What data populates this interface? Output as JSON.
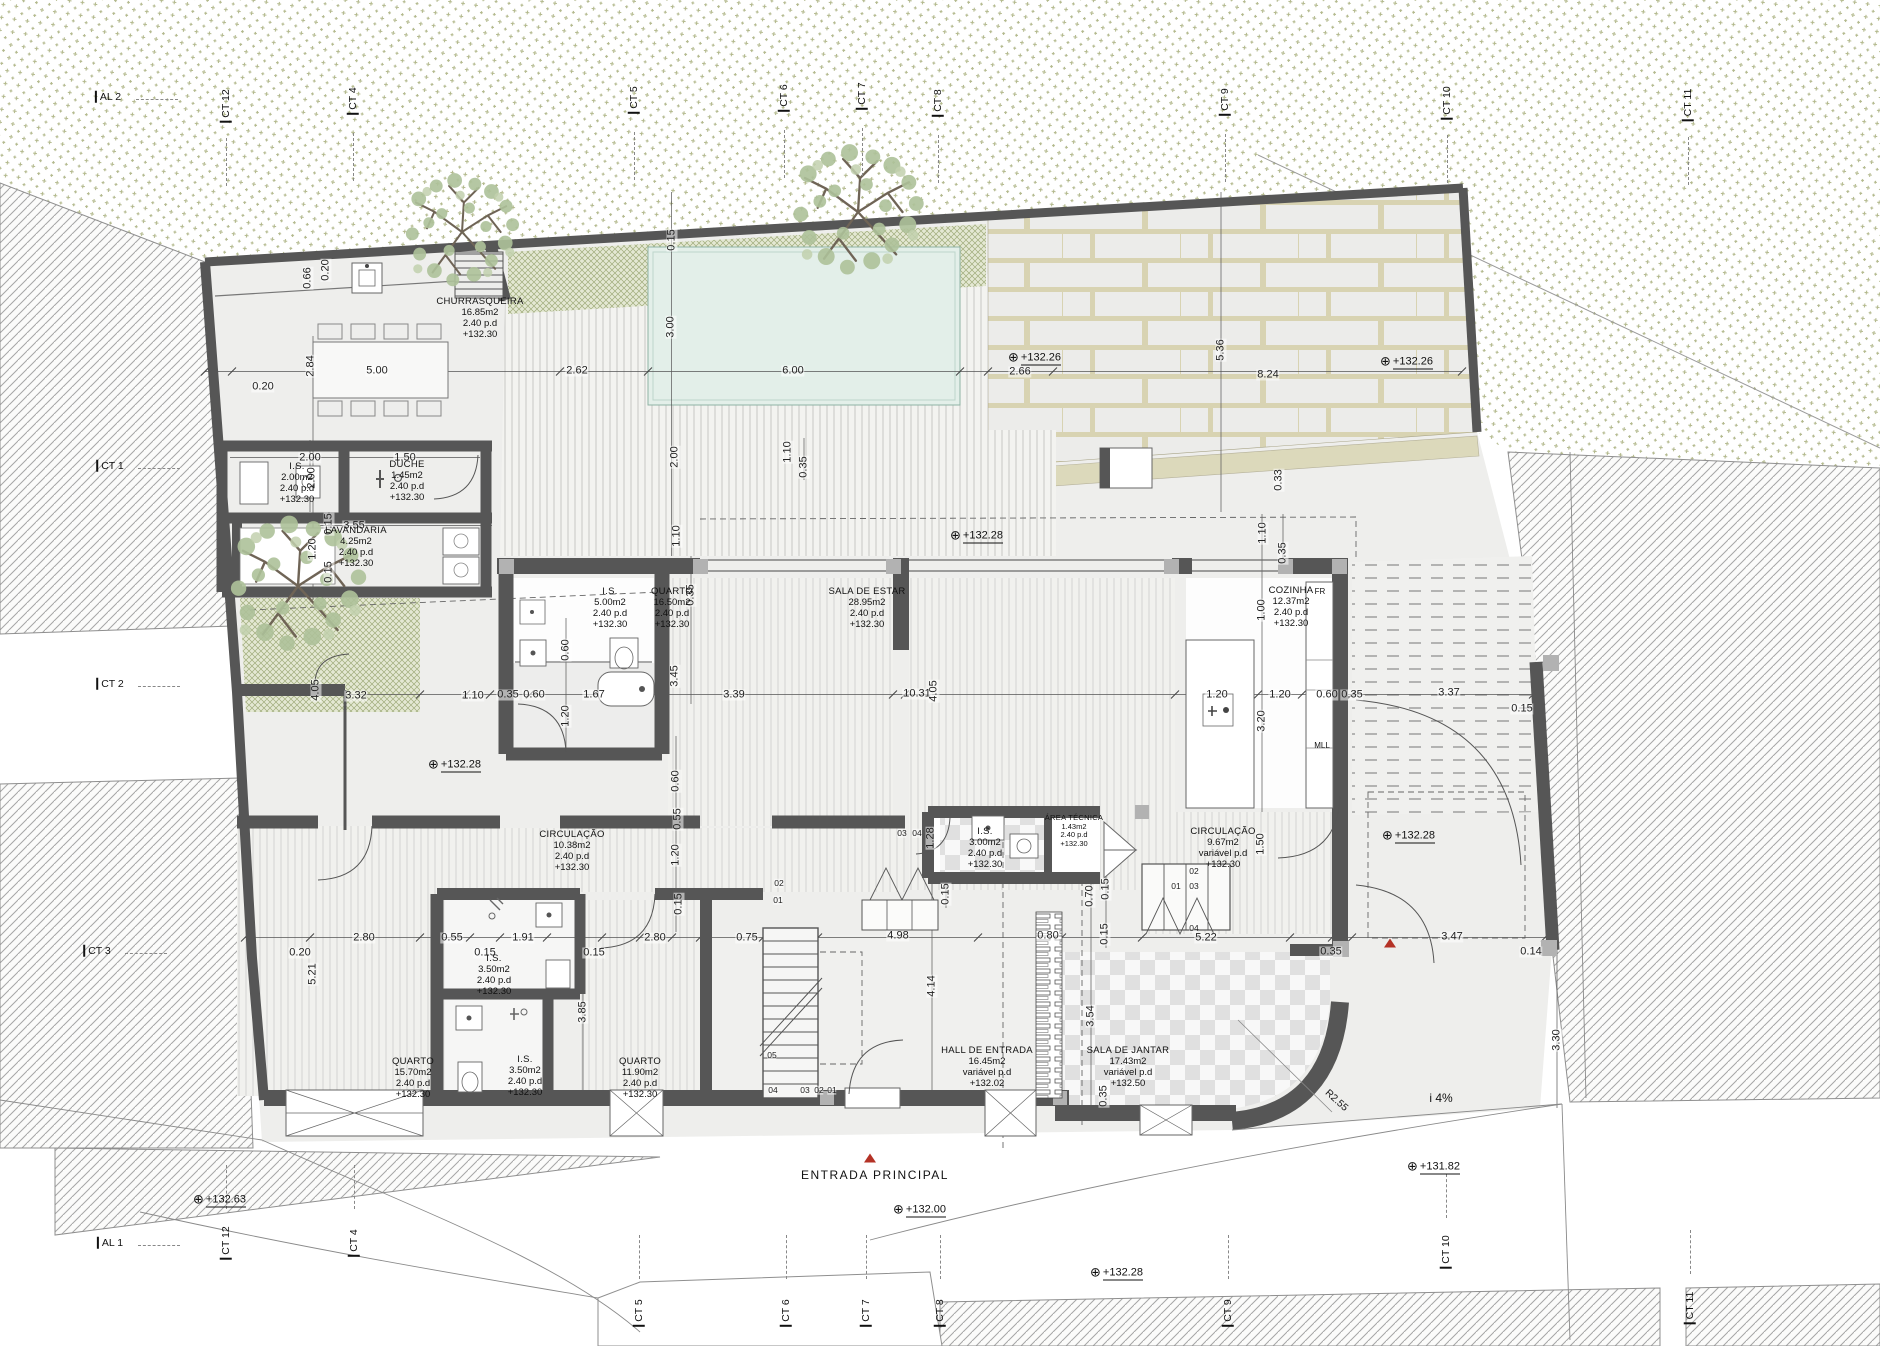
{
  "drawing": {
    "type_label": "floor-plan"
  },
  "colors": {
    "wall": "#565656",
    "accent_red": "#b43226",
    "pool": "#e3efe9",
    "veget": "#98a266",
    "paper": "#ffffff"
  },
  "grid": {
    "top": [
      {
        "t": "AL 2",
        "x": 108,
        "y": 97,
        "o": "h"
      },
      {
        "t": "CT 12",
        "x": 226,
        "y": 106,
        "o": "v"
      },
      {
        "t": "CT 4",
        "x": 353,
        "y": 101,
        "o": "v"
      },
      {
        "t": "CT 5",
        "x": 634,
        "y": 100,
        "o": "v"
      },
      {
        "t": "CT 6",
        "x": 784,
        "y": 98,
        "o": "v"
      },
      {
        "t": "CT 7",
        "x": 862,
        "y": 96,
        "o": "v"
      },
      {
        "t": "CT 8",
        "x": 938,
        "y": 103,
        "o": "v"
      },
      {
        "t": "CT 9",
        "x": 1225,
        "y": 102,
        "o": "v"
      },
      {
        "t": "CT 10",
        "x": 1447,
        "y": 103,
        "o": "v"
      },
      {
        "t": "CT 11",
        "x": 1688,
        "y": 105,
        "o": "v"
      }
    ],
    "left": [
      {
        "t": "CT 1",
        "x": 110,
        "y": 466,
        "o": "h"
      },
      {
        "t": "CT 2",
        "x": 110,
        "y": 684,
        "o": "h"
      },
      {
        "t": "CT 3",
        "x": 97,
        "y": 951,
        "o": "h"
      }
    ],
    "bottom": [
      {
        "t": "AL 1",
        "x": 110,
        "y": 1243,
        "o": "h"
      },
      {
        "t": "CT 12",
        "x": 226,
        "y": 1243,
        "o": "v"
      },
      {
        "t": "CT 4",
        "x": 354,
        "y": 1243,
        "o": "v"
      },
      {
        "t": "CT 5",
        "x": 639,
        "y": 1313,
        "o": "v"
      },
      {
        "t": "CT 6",
        "x": 786,
        "y": 1313,
        "o": "v"
      },
      {
        "t": "CT 7",
        "x": 866,
        "y": 1313,
        "o": "v"
      },
      {
        "t": "CT 8",
        "x": 940,
        "y": 1313,
        "o": "v"
      },
      {
        "t": "CT 9",
        "x": 1228,
        "y": 1313,
        "o": "v"
      },
      {
        "t": "CT 10",
        "x": 1446,
        "y": 1252,
        "o": "v"
      },
      {
        "t": "CT 11",
        "x": 1690,
        "y": 1308,
        "o": "v"
      }
    ]
  },
  "rooms": [
    {
      "name": "CHURRASQUEIRA",
      "area": "16.85m2",
      "height": "2.40  p.d",
      "level": "+132.30",
      "x": 480,
      "y": 319
    },
    {
      "name": "I.S.",
      "area": "2.00m2",
      "height": "2.40  p.d",
      "level": "+132.30",
      "x": 297,
      "y": 484
    },
    {
      "name": "DUCHE",
      "area": "1.45m2",
      "height": "2.40  p.d",
      "level": "+132.30",
      "x": 407,
      "y": 482
    },
    {
      "name": "LAVANDARIA",
      "area": "4.25m2",
      "height": "2.40  p.d",
      "level": "+132.30",
      "x": 356,
      "y": 548
    },
    {
      "name": "I.S.",
      "area": "5.00m2",
      "height": "2.40  p.d",
      "level": "+132.30",
      "x": 610,
      "y": 609
    },
    {
      "name": "QUARTO",
      "area": "16.50m2",
      "height": "2.40  p.d",
      "level": "+132.30",
      "x": 672,
      "y": 609
    },
    {
      "name": "SALA DE ESTAR",
      "area": "28.95m2",
      "height": "2.40  p.d",
      "level": "+132.30",
      "x": 867,
      "y": 609
    },
    {
      "name": "COZINHA",
      "area": "12.37m2",
      "height": "2.40  p.d",
      "level": "+132.30",
      "x": 1291,
      "y": 608
    },
    {
      "name": "CIRCULAÇÃO",
      "area": "10.38m2",
      "height": "2.40  p.d",
      "level": "+132.30",
      "x": 572,
      "y": 852
    },
    {
      "name": "I.S.",
      "area": "3.50m2",
      "height": "2.40  p.d",
      "level": "+132.30",
      "x": 494,
      "y": 976
    },
    {
      "name": "QUARTO",
      "area": "15.70m2",
      "height": "2.40  p.d",
      "level": "+132.30",
      "x": 413,
      "y": 1079
    },
    {
      "name": "I.S.",
      "area": "3.50m2",
      "height": "2.40  p.d",
      "level": "+132.30",
      "x": 525,
      "y": 1077
    },
    {
      "name": "QUARTO",
      "area": "11.90m2",
      "height": "2.40  p.d",
      "level": "+132.30",
      "x": 640,
      "y": 1079
    },
    {
      "name": "I.S.",
      "area": "3.00m2",
      "height": "2.40  p.d",
      "level": "+132.30",
      "x": 985,
      "y": 849
    },
    {
      "name": "ÁREA TÉCNICA",
      "area": "1.43m2",
      "height": "2.40  p.d",
      "level": "+132.30",
      "x": 1074,
      "y": 831,
      "fs": 7.5
    },
    {
      "name": "CIRCULAÇÃO",
      "area": "9.67m2",
      "height": "variável  p.d",
      "level": "+132.30",
      "x": 1223,
      "y": 849
    },
    {
      "name": "HALL DE ENTRADA",
      "area": "16.45m2",
      "height": "variável  p.d",
      "level": "+132.02",
      "x": 987,
      "y": 1068
    },
    {
      "name": "SALA DE JANTAR",
      "area": "17.43m2",
      "height": "variável  p.d",
      "level": "+132.50",
      "x": 1128,
      "y": 1068
    }
  ],
  "levels": [
    {
      "v": "+132.26",
      "x": 1008,
      "y": 357
    },
    {
      "v": "+132.26",
      "x": 1380,
      "y": 361
    },
    {
      "v": "+132.28",
      "x": 950,
      "y": 535
    },
    {
      "v": "+132.28",
      "x": 428,
      "y": 764
    },
    {
      "v": "+132.28",
      "x": 1382,
      "y": 835
    },
    {
      "v": "+132.28",
      "x": 1090,
      "y": 1272
    },
    {
      "v": "+132.00",
      "x": 893,
      "y": 1209
    },
    {
      "v": "+132.63",
      "x": 193,
      "y": 1199
    },
    {
      "v": "+131.82",
      "x": 1407,
      "y": 1166
    }
  ],
  "dims": [
    {
      "v": "0.66",
      "x": 308,
      "y": 278,
      "r": 1
    },
    {
      "v": "0.20",
      "x": 326,
      "y": 270,
      "r": 1
    },
    {
      "v": "2.84",
      "x": 311,
      "y": 366,
      "r": 1
    },
    {
      "v": "5.00",
      "x": 377,
      "y": 371
    },
    {
      "v": "0.20",
      "x": 263,
      "y": 387
    },
    {
      "v": "2.62",
      "x": 577,
      "y": 371
    },
    {
      "v": "6.00",
      "x": 793,
      "y": 371
    },
    {
      "v": "2.66",
      "x": 1020,
      "y": 372
    },
    {
      "v": "8.24",
      "x": 1268,
      "y": 375
    },
    {
      "v": "5.36",
      "x": 1221,
      "y": 350,
      "r": 1
    },
    {
      "v": "3.00",
      "x": 671,
      "y": 327,
      "r": 1
    },
    {
      "v": "2.00",
      "x": 675,
      "y": 457,
      "r": 1
    },
    {
      "v": "0.15",
      "x": 672,
      "y": 240,
      "r": 1
    },
    {
      "v": "0.33",
      "x": 1279,
      "y": 480,
      "r": 1
    },
    {
      "v": "1.10",
      "x": 1263,
      "y": 533,
      "r": 1
    },
    {
      "v": "0.35",
      "x": 1283,
      "y": 553,
      "r": 1
    },
    {
      "v": "1.10",
      "x": 788,
      "y": 452,
      "r": 1
    },
    {
      "v": "0.35",
      "x": 804,
      "y": 467,
      "r": 1
    },
    {
      "v": "2.00",
      "x": 310,
      "y": 458
    },
    {
      "v": "1.50",
      "x": 405,
      "y": 458
    },
    {
      "v": "2.00",
      "x": 312,
      "y": 478,
      "r": 1
    },
    {
      "v": "0.15",
      "x": 329,
      "y": 524,
      "r": 1
    },
    {
      "v": "3.55",
      "x": 354,
      "y": 526
    },
    {
      "v": "1.20",
      "x": 313,
      "y": 549,
      "r": 1
    },
    {
      "v": "0.15",
      "x": 329,
      "y": 572,
      "r": 1
    },
    {
      "v": "3.32",
      "x": 356,
      "y": 696
    },
    {
      "v": "1.10",
      "x": 473,
      "y": 696
    },
    {
      "v": "0.35",
      "x": 508,
      "y": 695
    },
    {
      "v": "0.60",
      "x": 534,
      "y": 695
    },
    {
      "v": "1.67",
      "x": 594,
      "y": 695
    },
    {
      "v": "3.39",
      "x": 734,
      "y": 695
    },
    {
      "v": "10.31",
      "x": 917,
      "y": 694
    },
    {
      "v": "4.05",
      "x": 934,
      "y": 691,
      "r": 1
    },
    {
      "v": "1.20",
      "x": 1217,
      "y": 695
    },
    {
      "v": "1.20",
      "x": 1280,
      "y": 695
    },
    {
      "v": "0.60",
      "x": 1327,
      "y": 695
    },
    {
      "v": "0.35",
      "x": 1352,
      "y": 695
    },
    {
      "v": "3.37",
      "x": 1449,
      "y": 693
    },
    {
      "v": "0.15",
      "x": 1522,
      "y": 709
    },
    {
      "v": "4.05",
      "x": 316,
      "y": 690,
      "r": 1
    },
    {
      "v": "3.45",
      "x": 675,
      "y": 676,
      "r": 1
    },
    {
      "v": "0.35",
      "x": 691,
      "y": 595,
      "r": 1
    },
    {
      "v": "1.10",
      "x": 677,
      "y": 536,
      "r": 1
    },
    {
      "v": "0.60",
      "x": 566,
      "y": 650,
      "r": 1
    },
    {
      "v": "1.20",
      "x": 566,
      "y": 716,
      "r": 1
    },
    {
      "v": "1.00",
      "x": 1262,
      "y": 610,
      "r": 1
    },
    {
      "v": "3.20",
      "x": 1262,
      "y": 721,
      "r": 1
    },
    {
      "v": "0.60",
      "x": 676,
      "y": 781,
      "r": 1
    },
    {
      "v": "0.55",
      "x": 678,
      "y": 819,
      "r": 1
    },
    {
      "v": "1.20",
      "x": 676,
      "y": 855,
      "r": 1
    },
    {
      "v": "0.15",
      "x": 679,
      "y": 904,
      "r": 1
    },
    {
      "v": "0.20",
      "x": 300,
      "y": 953
    },
    {
      "v": "5.21",
      "x": 313,
      "y": 974,
      "r": 1
    },
    {
      "v": "2.80",
      "x": 364,
      "y": 938
    },
    {
      "v": "0.55",
      "x": 452,
      "y": 938
    },
    {
      "v": "1.91",
      "x": 523,
      "y": 938
    },
    {
      "v": "0.15",
      "x": 485,
      "y": 953
    },
    {
      "v": "0.15",
      "x": 594,
      "y": 953
    },
    {
      "v": "2.80",
      "x": 655,
      "y": 938
    },
    {
      "v": "0.75",
      "x": 747,
      "y": 938
    },
    {
      "v": "4.98",
      "x": 898,
      "y": 936
    },
    {
      "v": "0.80",
      "x": 1048,
      "y": 936
    },
    {
      "v": "5.22",
      "x": 1206,
      "y": 938
    },
    {
      "v": "0.35",
      "x": 1331,
      "y": 952
    },
    {
      "v": "3.47",
      "x": 1452,
      "y": 937
    },
    {
      "v": "0.14",
      "x": 1531,
      "y": 952
    },
    {
      "v": "3.85",
      "x": 583,
      "y": 1012,
      "r": 1
    },
    {
      "v": "4.14",
      "x": 932,
      "y": 986,
      "r": 1
    },
    {
      "v": "0.15",
      "x": 946,
      "y": 894,
      "r": 1
    },
    {
      "v": "1.28",
      "x": 931,
      "y": 838,
      "r": 1
    },
    {
      "v": "0.70",
      "x": 1090,
      "y": 896,
      "r": 1
    },
    {
      "v": "0.15",
      "x": 1106,
      "y": 889,
      "r": 1
    },
    {
      "v": "0.15",
      "x": 1105,
      "y": 934,
      "r": 1
    },
    {
      "v": "3.54",
      "x": 1091,
      "y": 1016,
      "r": 1
    },
    {
      "v": "0.35",
      "x": 1104,
      "y": 1096,
      "r": 1
    },
    {
      "v": "1.50",
      "x": 1261,
      "y": 844,
      "r": 1
    },
    {
      "v": "3.30",
      "x": 1557,
      "y": 1040,
      "r": 1
    }
  ],
  "steps": [
    {
      "v": "02",
      "x": 779,
      "y": 883
    },
    {
      "v": "01",
      "x": 778,
      "y": 900
    },
    {
      "v": "05",
      "x": 772,
      "y": 1055
    },
    {
      "v": "04",
      "x": 773,
      "y": 1090
    },
    {
      "v": "03",
      "x": 805,
      "y": 1090
    },
    {
      "v": "02",
      "x": 819,
      "y": 1090
    },
    {
      "v": "01",
      "x": 832,
      "y": 1090
    },
    {
      "v": "03",
      "x": 902,
      "y": 833
    },
    {
      "v": "04",
      "x": 917,
      "y": 833
    },
    {
      "v": "01",
      "x": 1176,
      "y": 886
    },
    {
      "v": "02",
      "x": 1194,
      "y": 871
    },
    {
      "v": "03",
      "x": 1194,
      "y": 886
    },
    {
      "v": "04",
      "x": 1194,
      "y": 928
    }
  ],
  "annotations": [
    {
      "id": "entrance-label",
      "v": "ENTRADA  PRINCIPAL",
      "x": 875,
      "y": 1175,
      "fs": 12,
      "ls": 1.5
    },
    {
      "id": "slope-label",
      "v": "i  4%",
      "x": 1441,
      "y": 1098,
      "fs": 12
    },
    {
      "id": "radius-label",
      "v": "R2.55",
      "x": 1336,
      "y": 1101,
      "fs": 10,
      "rot": 42
    },
    {
      "id": "fridge-label",
      "v": "FR",
      "x": 1320,
      "y": 592,
      "fs": 8
    },
    {
      "id": "dishwasher-label",
      "v": "MLL",
      "x": 1322,
      "y": 746,
      "fs": 8
    }
  ],
  "markers": {
    "entrance_triangle": {
      "x": 870,
      "y": 1158
    },
    "gate_triangle": {
      "x": 1390,
      "y": 943
    }
  }
}
